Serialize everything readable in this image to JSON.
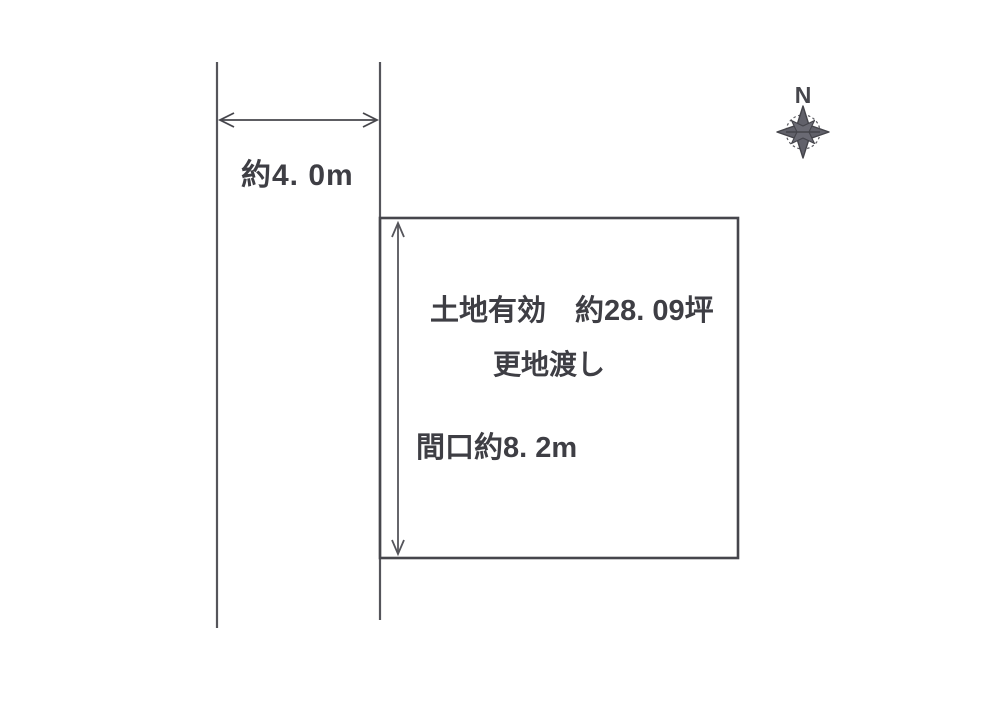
{
  "diagram": {
    "type": "land-plot-site-plan",
    "road": {
      "width_label": "約4. 0m"
    },
    "plot": {
      "area_label": "土地有効　約28. 09坪",
      "condition_label": "更地渡し",
      "frontage_label": "間口約8. 2m"
    },
    "compass": {
      "north_label": "N"
    },
    "colors": {
      "ink": "#46464c",
      "text": "#3e3e44",
      "background": "#ffffff"
    }
  }
}
